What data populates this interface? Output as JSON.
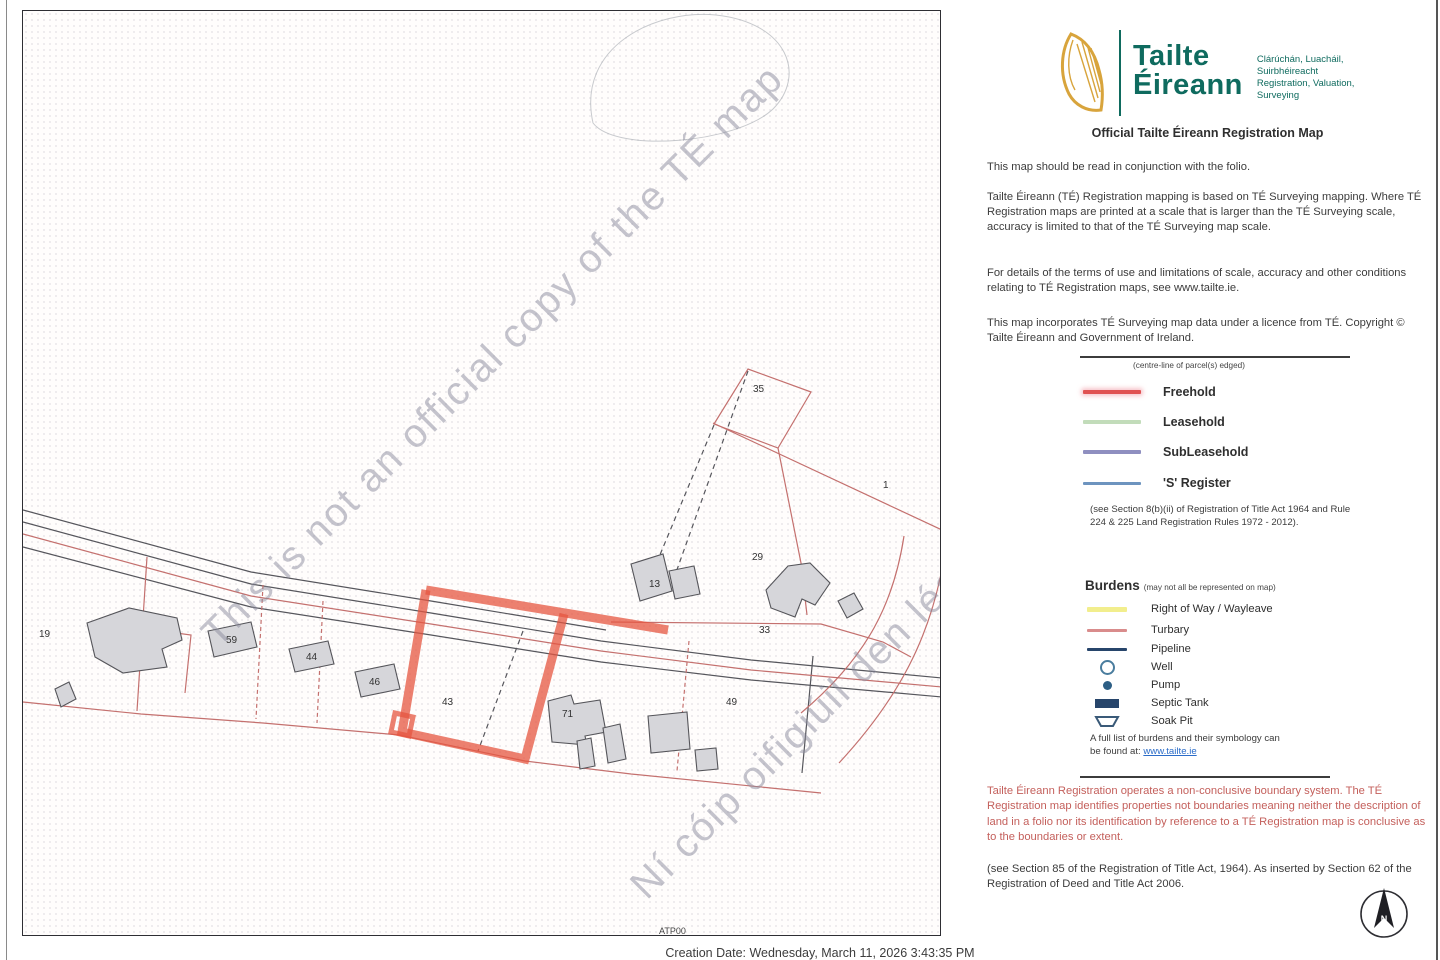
{
  "logo": {
    "brand_line1": "Tailte",
    "brand_line2": "Éireann",
    "tagline_line1": "Clárúchán, Luacháil,",
    "tagline_line2": "Suirbhéireacht",
    "tagline_line3": "Registration, Valuation,",
    "tagline_line4": "Surveying",
    "brand_color": "#0f6b5f",
    "harp_color": "#d8a43c"
  },
  "header": {
    "title": "Official Tailte Éireann Registration Map"
  },
  "paragraphs": {
    "p1": "This map should be read in conjunction with the folio.",
    "p2": "Tailte Éireann (TÉ) Registration mapping is based on TÉ Surveying mapping. Where TÉ Registration maps are printed at a scale that is larger than the TÉ Surveying scale, accuracy is limited to that of the TÉ Surveying map scale.",
    "p3": "For details of the terms of use and limitations of scale, accuracy and other conditions relating to TÉ Registration maps, see www.tailte.ie.",
    "p4": "This map incorporates TÉ Surveying map data under a licence from TÉ. Copyright © Tailte Éireann and Government of Ireland."
  },
  "legend": {
    "note": "(centre-line of parcel(s) edged)",
    "items": [
      {
        "label": "Freehold",
        "color": "#e05252"
      },
      {
        "label": "Leasehold",
        "color": "#c2dcba"
      },
      {
        "label": "SubLeasehold",
        "color": "#8f8fc0"
      },
      {
        "label": "'S' Register",
        "color": "#6d94bf"
      }
    ],
    "statute_note": "(see Section 8(b)(ii) of Registration of Title Act 1964 and Rule 224 & 225 Land Registration Rules 1972 - 2012)."
  },
  "burdens": {
    "heading": "Burdens",
    "heading_note": "(may not all be represented on map)",
    "items": [
      {
        "label": "Right of Way / Wayleave",
        "symbol": "line",
        "color": "#f2ee8d"
      },
      {
        "label": "Turbary",
        "symbol": "line",
        "color": "#d98c8c"
      },
      {
        "label": "Pipeline",
        "symbol": "line",
        "color": "#27456b"
      },
      {
        "label": "Well",
        "symbol": "circle-outline",
        "color": "#4a7d9e"
      },
      {
        "label": "Pump",
        "symbol": "dot",
        "color": "#2d5f85"
      },
      {
        "label": "Septic Tank",
        "symbol": "rect",
        "color": "#27456b"
      },
      {
        "label": "Soak Pit",
        "symbol": "trapezoid",
        "color": "#3a5a78"
      }
    ],
    "footer_line1": "A full list of burdens and their symbology can",
    "footer_line2_prefix": "be found at: ",
    "footer_link": "www.tailte.ie"
  },
  "warning": {
    "text": "Tailte Éireann Registration operates a non-conclusive boundary system. The TÉ Registration map identifies properties not boundaries meaning neither the description of land in a folio nor its identification by reference to a TÉ Registration map is conclusive as to the boundaries or extent.",
    "color": "#c4605c"
  },
  "statute_footer": "(see Section 85 of the Registration of Title Act, 1964). As inserted by Section 62 of the Registration of Deed and Title Act 2006.",
  "map": {
    "watermark_line1": "This is not an official copy of the TÉ map",
    "watermark_line2": "Ní cóip oifigiúil den léarscáil TÉ é seo",
    "sheet_label": "ATP00",
    "highlight_color": "#e65540",
    "boundary_color": "#c4706e",
    "road_color": "#56565c",
    "building_fill": "#d6d6da",
    "parcels": [
      {
        "label": "35"
      },
      {
        "label": "1"
      },
      {
        "label": "29"
      },
      {
        "label": "13"
      },
      {
        "label": "33"
      },
      {
        "label": "19"
      },
      {
        "label": "59"
      },
      {
        "label": "44"
      },
      {
        "label": "46"
      },
      {
        "label": "43"
      },
      {
        "label": "71"
      },
      {
        "label": "49"
      }
    ]
  },
  "compass": {
    "label": "N"
  },
  "footer": {
    "creation_date": "Creation Date: Wednesday, March 11, 2026 3:43:35 PM"
  }
}
